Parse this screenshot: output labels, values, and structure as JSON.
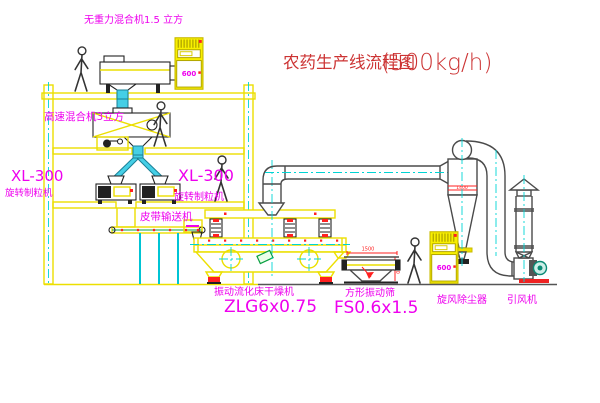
{
  "title": {
    "name": "农药生产线流程图",
    "capacity": "(500kg/h)"
  },
  "labels": {
    "gravity_mixer": "无重力混合机1.5 立方",
    "speed_mixer": "高速混合机3立方",
    "granulator_left_model": "XL-300",
    "granulator_left_name": "旋转制粒机",
    "granulator_center_model": "XL-300",
    "granulator_center_name": "旋转制粒机",
    "belt_conveyor": "皮带输送机",
    "dryer_name": "振动流化床干燥机",
    "dryer_model": "ZLG6x0.75",
    "screen_name": "方形振动筛",
    "screen_model": "FS0.6x1.5",
    "cyclone_name": "旋风除尘器",
    "fan_name": "引风机"
  },
  "annotations": {
    "cabinet_display": "600",
    "cyclone_dim": "1400",
    "screen_dim_width": "1500",
    "screen_dim_height": "540"
  },
  "colors": {
    "structure_yellow": "#ecdf00",
    "label_magenta": "#ee00ee",
    "title_red": "#cc3333",
    "centerline_cyan": "#00d4d4",
    "pipe_cyan_fill": "#45cfe6",
    "duct_dark": "#4a4a4a",
    "detail_red": "#ff2020",
    "motor_green": "#089f40"
  }
}
